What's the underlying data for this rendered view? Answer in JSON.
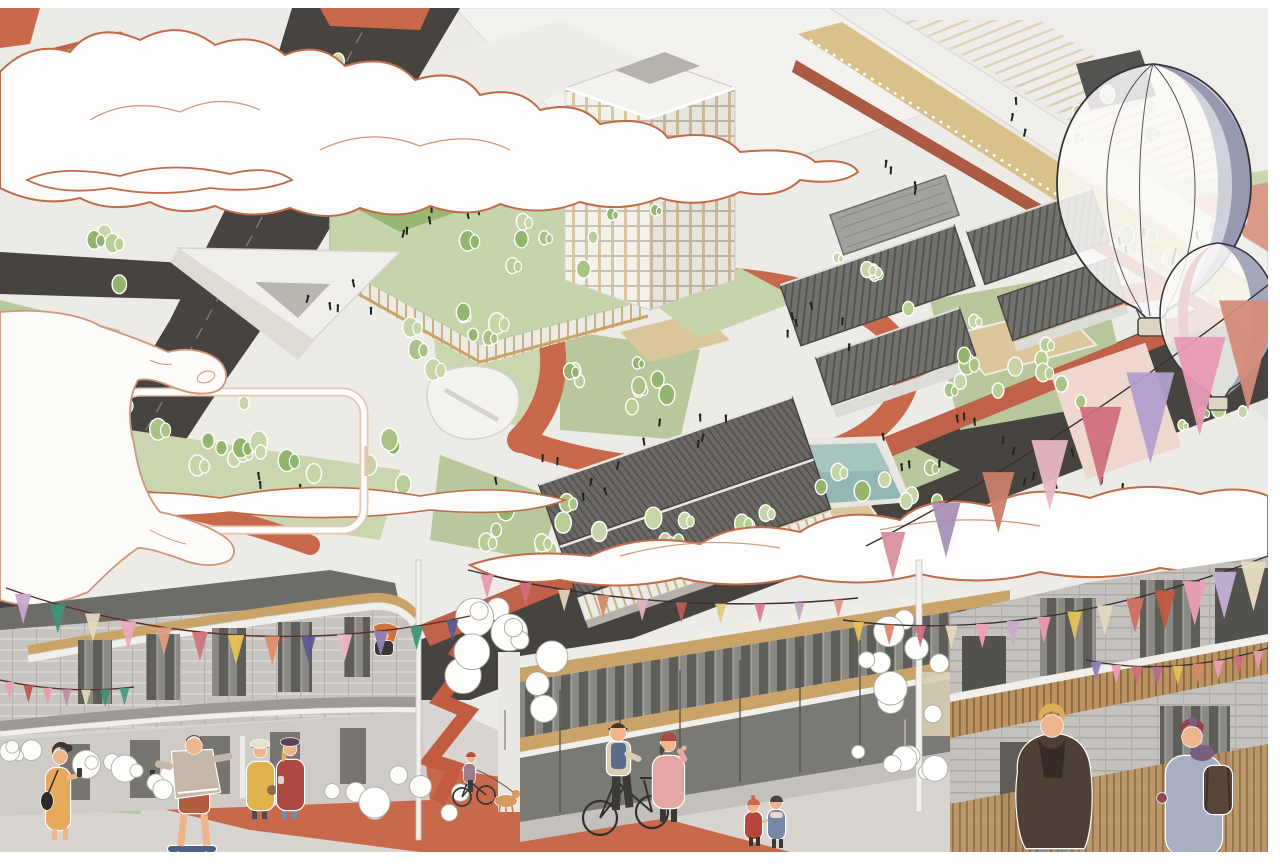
{
  "illustration": {
    "kind": "architectural-axonometric-masterplan-with-street-scene",
    "text_content": "none",
    "elements": [
      "aerial-masterplan",
      "dark-roads",
      "red-pedestrian-paths",
      "lawns-and-trees",
      "residential-tower",
      "green-roof-podium",
      "market-hall",
      "courtyard-roofs",
      "swimming-pool",
      "elevated-walkway",
      "outlined-clouds",
      "hand-holding-phone-frame",
      "hot-air-balloon-large",
      "hot-air-balloon-small",
      "bunting-garlands",
      "street-scene-buildings",
      "street-figures",
      "sketch-trees",
      "white-shrub-planters"
    ]
  },
  "palette": {
    "paper": "#ecebe6",
    "road_dark": "#474440",
    "road_line": "#8a8781",
    "terracotta": "#c9694c",
    "terracotta_deep": "#c0614a",
    "walkway_red": "#ad5a44",
    "lawn": "#b9c79d",
    "lawn_light": "#c9d6af",
    "field_green": "#9ab671",
    "sand": "#dcc79c",
    "pool_teal": "#93b7b3",
    "pool_teal_light": "#a9c6c2",
    "slab_white": "#f3f2ee",
    "roof_dark": "#6e6c68",
    "tan_wood": "#c9a368",
    "tan_deck": "#d9c18c",
    "cloud_fill": "#fefdfb",
    "cloud_outline": "#c06c49",
    "cloud_inner": "#cf9679",
    "hand_fill": "#fdfcf9",
    "hand_outline": "#d29577",
    "phone_frame_soft": "#e9c6b0",
    "balloon_slate": "#9296ad",
    "balloon_pink": "#ead2d4",
    "balloon_outline": "#35333a",
    "basket": "#ded5c4",
    "pavement": "#d8d5d0",
    "block_gray": "#c8c5c0",
    "crowd_black": "#26241f",
    "shrub_stroke": "#b2afa9",
    "skin": "#eeb58c",
    "tree_greens": [
      "#a9c386",
      "#b9cf97",
      "#93b56e",
      "#c6d6a8"
    ]
  },
  "figures": {
    "phone_woman": {
      "dress": "#e8a95c",
      "hair": "#3f3430",
      "bag": "#2e2a28"
    },
    "skateboarder": {
      "hoodie": "#c4b7aa",
      "shorts": "#b35c3f",
      "board": "#4d5f82",
      "cap": "#4a4236"
    },
    "yellow_coat": {
      "coat": "#e0b34e",
      "hat": "#e9e0cc",
      "bag": "#8a6a55",
      "pants": "#4b4a52"
    },
    "red_coat": {
      "coat": "#ad4b43",
      "hat": "#5c4458",
      "jeans": "#7e89a1",
      "hair": "#d9b36a"
    },
    "balcony_person": {
      "hair": "#d4713e",
      "top": "#3a3633"
    },
    "cyclist": {
      "helmet": "#b94f42",
      "top": "#9d7d8a",
      "dog": "#d89a5f"
    },
    "bicycle_man": {
      "vest": "#5b6d8d",
      "jacket": "#d9cdb4",
      "pants": "#3c3a38",
      "cap": "#3e3b38"
    },
    "pink_coat": {
      "coat": "#e5a7a3",
      "beret": "#ab4a42",
      "hair": "#4a4643"
    },
    "kid_red": {
      "coat": "#b5473f",
      "hat": "#c96a50"
    },
    "kid_blue": {
      "coat": "#7787a8",
      "hair": "#4a4441"
    },
    "brown_coat_man": {
      "coat": "#4e4036",
      "collar": "#362c25",
      "hair": "#dfae57",
      "pants": "#8d8a85"
    },
    "backpack_person": {
      "coat": "#a8afc2",
      "beanie": "#983f46",
      "scarf": "#7c5f7e",
      "backpack": "#5a463a",
      "glove": "#8e4a50"
    }
  },
  "scene": {
    "garlands": [
      {
        "name": "right-large",
        "string": "#35312e",
        "fw": 40,
        "fh": 76,
        "pts": [
          [
            1272,
            282
          ],
          [
            1062,
            446
          ],
          [
            866,
            546
          ]
        ],
        "flags": [
          {
            "c": "#d48b7a",
            "s": 1.45
          },
          {
            "c": "#e79ab3",
            "s": 1.3
          },
          {
            "c": "#b2a0cc",
            "s": 1.2
          },
          {
            "c": "#d06f7e",
            "s": 1.05
          },
          {
            "c": "#e7b7c4",
            "s": 0.92
          },
          {
            "c": "#c97f67",
            "s": 0.8
          },
          {
            "c": "#a98fb8",
            "s": 0.72
          },
          {
            "c": "#d98f9e",
            "s": 0.62
          }
        ]
      },
      {
        "name": "over-plan",
        "string": "#35312e",
        "fw": 18,
        "fh": 32,
        "pts": [
          [
            468,
            570
          ],
          [
            660,
            618
          ],
          [
            858,
            598
          ]
        ],
        "flags": [
          {
            "c": "#e59cb0",
            "s": 0.75
          },
          {
            "c": "#cf6f80",
            "s": 0.7
          },
          {
            "c": "#e3d4bd",
            "s": 0.68
          },
          {
            "c": "#d08a6e",
            "s": 0.7
          },
          {
            "c": "#e8b0be",
            "s": 0.66
          },
          {
            "c": "#b75f55",
            "s": 0.64
          },
          {
            "c": "#e0c97f",
            "s": 0.62
          },
          {
            "c": "#d77e8e",
            "s": 0.6
          },
          {
            "c": "#c9a3c0",
            "s": 0.58
          },
          {
            "c": "#e0948a",
            "s": 0.56
          }
        ]
      },
      {
        "name": "left-building",
        "string": "#5a2f2a",
        "fw": 22,
        "fh": 40,
        "pts": [
          [
            6,
            588
          ],
          [
            235,
            668
          ],
          [
            470,
            616
          ]
        ],
        "flags": [
          {
            "c": "#c9a8d0",
            "s": 0.75
          },
          {
            "c": "#3f9478",
            "s": 0.72
          },
          {
            "c": "#e5d7bd",
            "s": 0.7
          },
          {
            "c": "#eaa9bf",
            "s": 0.72
          },
          {
            "c": "#df9d7e",
            "s": 0.7
          },
          {
            "c": "#d0737f",
            "s": 0.72
          },
          {
            "c": "#e7c254",
            "s": 0.74
          },
          {
            "c": "#df8f66",
            "s": 0.7
          },
          {
            "c": "#5a5d8f",
            "s": 0.66
          },
          {
            "c": "#ecb9c8",
            "s": 0.68
          },
          {
            "c": "#8d7fb5",
            "s": 0.64
          },
          {
            "c": "#3f9478",
            "s": 0.6
          },
          {
            "c": "#5a5d8f",
            "s": 0.55
          }
        ]
      },
      {
        "name": "left-small",
        "string": "#5a2f2a",
        "fw": 12,
        "fh": 22,
        "pts": [
          [
            0,
            680
          ],
          [
            68,
            695
          ],
          [
            134,
            687
          ]
        ],
        "flags": [
          {
            "c": "#eb9fb4",
            "s": 0.8
          },
          {
            "c": "#bf5844",
            "s": 0.8
          },
          {
            "c": "#e89cab",
            "s": 0.8
          },
          {
            "c": "#c38ba8",
            "s": 0.8
          },
          {
            "c": "#e3d3bb",
            "s": 0.8
          },
          {
            "c": "#3d8f74",
            "s": 0.8
          },
          {
            "c": "#4a9b80",
            "s": 0.8
          }
        ]
      },
      {
        "name": "right-building",
        "string": "#35312e",
        "fw": 22,
        "fh": 42,
        "pts": [
          [
            843,
            620
          ],
          [
            1030,
            646
          ],
          [
            1268,
            556
          ]
        ],
        "flags": [
          {
            "c": "#e7c254",
            "s": 0.5
          },
          {
            "c": "#d9886e",
            "s": 0.5
          },
          {
            "c": "#cf6f80",
            "s": 0.52
          },
          {
            "c": "#e5d7bd",
            "s": 0.55
          },
          {
            "c": "#ec9fb5",
            "s": 0.58
          },
          {
            "c": "#c9a8d0",
            "s": 0.6
          },
          {
            "c": "#e89cab",
            "s": 0.62
          },
          {
            "c": "#e7c254",
            "s": 0.66
          },
          {
            "c": "#e5d7bd",
            "s": 0.72
          },
          {
            "c": "#d07060",
            "s": 0.82
          },
          {
            "c": "#bf5940",
            "s": 0.95
          },
          {
            "c": "#eb9fb6",
            "s": 1.05
          },
          {
            "c": "#c4afd6",
            "s": 1.12
          },
          {
            "c": "#e8ddc2",
            "s": 1.18
          }
        ]
      },
      {
        "name": "right-lower",
        "string": "#35312e",
        "fw": 13,
        "fh": 24,
        "pts": [
          [
            1086,
            660
          ],
          [
            1172,
            678
          ],
          [
            1268,
            648
          ]
        ],
        "flags": [
          {
            "c": "#8d7fb5",
            "s": 0.8
          },
          {
            "c": "#eb9fb4",
            "s": 0.8
          },
          {
            "c": "#cf6f80",
            "s": 0.8
          },
          {
            "c": "#b7699a",
            "s": 0.8
          },
          {
            "c": "#e7c254",
            "s": 0.8
          },
          {
            "c": "#d9886e",
            "s": 0.8
          },
          {
            "c": "#eb9fb4",
            "s": 0.8
          },
          {
            "c": "#cf6f80",
            "s": 0.8
          },
          {
            "c": "#e89cab",
            "s": 0.8
          }
        ]
      }
    ],
    "tree_clusters": [
      {
        "x": 320,
        "y": 72,
        "n": 5,
        "sx": 70,
        "sy": 36,
        "s": 6.5
      },
      {
        "x": 240,
        "y": 132,
        "n": 4,
        "sx": 60,
        "sy": 40,
        "s": 6
      },
      {
        "x": 150,
        "y": 435,
        "n": 9,
        "sx": 250,
        "sy": 70,
        "s": 7
      },
      {
        "x": 300,
        "y": 472,
        "n": 12,
        "sx": 240,
        "sy": 70,
        "s": 6.5
      },
      {
        "x": 620,
        "y": 524,
        "n": 13,
        "sx": 300,
        "sy": 55,
        "s": 6.5
      },
      {
        "x": 520,
        "y": 248,
        "n": 7,
        "sx": 150,
        "sy": 60,
        "s": 6
      },
      {
        "x": 455,
        "y": 345,
        "n": 9,
        "sx": 95,
        "sy": 75,
        "s": 6.5
      },
      {
        "x": 612,
        "y": 390,
        "n": 9,
        "sx": 120,
        "sy": 60,
        "s": 6
      },
      {
        "x": 1000,
        "y": 360,
        "n": 12,
        "sx": 170,
        "sy": 95,
        "s": 6.5
      },
      {
        "x": 1175,
        "y": 248,
        "n": 7,
        "sx": 120,
        "sy": 70,
        "s": 6
      },
      {
        "x": 885,
        "y": 478,
        "n": 8,
        "sx": 130,
        "sy": 55,
        "s": 6
      },
      {
        "x": 760,
        "y": 560,
        "n": 9,
        "sx": 200,
        "sy": 40,
        "s": 6
      },
      {
        "x": 1115,
        "y": 118,
        "n": 5,
        "sx": 85,
        "sy": 50,
        "s": 5.5
      },
      {
        "x": 870,
        "y": 282,
        "n": 5,
        "sx": 90,
        "sy": 55,
        "s": 5.5
      },
      {
        "x": 640,
        "y": 205,
        "n": 4,
        "sx": 80,
        "sy": 30,
        "s": 5.5
      },
      {
        "x": 90,
        "y": 255,
        "n": 4,
        "sx": 90,
        "sy": 60,
        "s": 6
      },
      {
        "x": 990,
        "y": 560,
        "n": 6,
        "sx": 120,
        "sy": 30,
        "s": 5.5
      },
      {
        "x": 1210,
        "y": 420,
        "n": 4,
        "sx": 70,
        "sy": 40,
        "s": 5.5
      }
    ],
    "crowd_clusters": [
      {
        "x": 470,
        "y": 215,
        "n": 9,
        "sx": 150,
        "sy": 50
      },
      {
        "x": 565,
        "y": 480,
        "n": 8,
        "sx": 180,
        "sy": 55
      },
      {
        "x": 700,
        "y": 435,
        "n": 6,
        "sx": 120,
        "sy": 40
      },
      {
        "x": 950,
        "y": 445,
        "n": 9,
        "sx": 160,
        "sy": 55
      },
      {
        "x": 1060,
        "y": 478,
        "n": 7,
        "sx": 140,
        "sy": 45
      },
      {
        "x": 1150,
        "y": 262,
        "n": 8,
        "sx": 110,
        "sy": 60
      },
      {
        "x": 830,
        "y": 332,
        "n": 6,
        "sx": 100,
        "sy": 50
      },
      {
        "x": 350,
        "y": 302,
        "n": 5,
        "sx": 90,
        "sy": 40
      },
      {
        "x": 270,
        "y": 482,
        "n": 4,
        "sx": 110,
        "sy": 40
      },
      {
        "x": 890,
        "y": 182,
        "n": 4,
        "sx": 80,
        "sy": 40
      },
      {
        "x": 620,
        "y": 560,
        "n": 5,
        "sx": 160,
        "sy": 30
      },
      {
        "x": 1010,
        "y": 120,
        "n": 3,
        "sx": 60,
        "sy": 40
      }
    ],
    "shrub_clusters": [
      {
        "x": 120,
        "y": 772,
        "n": 8,
        "sx": 110,
        "sy": 36,
        "r": 11
      },
      {
        "x": 400,
        "y": 792,
        "n": 8,
        "sx": 150,
        "sy": 46,
        "r": 12
      },
      {
        "x": 35,
        "y": 752,
        "n": 5,
        "sx": 60,
        "sy": 22,
        "r": 8
      },
      {
        "x": 890,
        "y": 762,
        "n": 6,
        "sx": 110,
        "sy": 34,
        "r": 10
      }
    ],
    "sketch_trees": [
      {
        "x": 505,
        "y": 645,
        "n": 11,
        "sx": 100,
        "sy": 130,
        "r": 15
      },
      {
        "x": 905,
        "y": 662,
        "n": 9,
        "sx": 85,
        "sy": 115,
        "r": 13
      }
    ],
    "balloons": {
      "large": {
        "cx": 1153,
        "cy": 185,
        "white": "#fbfaf8",
        "slate": "#9296ad",
        "mid": "#c6c8d4"
      },
      "small": {
        "cx": 1218,
        "cy": 315,
        "white": "#fbfaf8",
        "pink": "#ead2d4",
        "slate": "#9a9eb4"
      }
    },
    "margins": {
      "top": 8,
      "right": 12,
      "bottom": 15
    }
  }
}
